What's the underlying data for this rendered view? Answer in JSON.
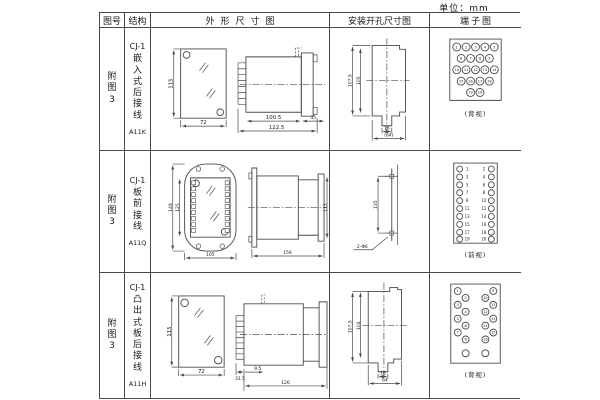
{
  "unit_label": "单位：mm",
  "headers": {
    "fig_no": "图号",
    "structure": "结构",
    "outline": "外形尺寸图",
    "install": "安装开孔尺寸图",
    "terminal": "端子图"
  },
  "rows": [
    {
      "fig": "附图3",
      "model": "CJ-1",
      "structure_type": "嵌入式后接线",
      "code": "A11K",
      "outline": {
        "height": "115",
        "width": "72",
        "body_len": "100.5",
        "total_len": "122.5",
        "flange_len": "35"
      },
      "install": {
        "outer_h": "107.5",
        "inner_h": "105",
        "slot_w": "16",
        "overall_w": "(64)"
      },
      "terminal": {
        "view": "(背视)",
        "numbers": [
          "1",
          "2",
          "3",
          "4",
          "5",
          "6",
          "7",
          "8",
          "9",
          "10",
          "11",
          "12",
          "13",
          "14",
          "15",
          "16",
          "17",
          "18",
          "19",
          "20"
        ]
      }
    },
    {
      "fig": "附图3",
      "model": "CJ-1",
      "structure_type": "板前接线",
      "code": "A11Q",
      "outline": {
        "outer_h": "149",
        "inner_h": "125",
        "width": "105",
        "length": "156",
        "height": "115"
      },
      "install": {
        "hole_spacing": "135",
        "hole_note": "2-Φ6"
      },
      "terminal": {
        "view": "(前视)",
        "left_numbers": [
          "1",
          "3",
          "5",
          "7",
          "9",
          "11",
          "13",
          "15",
          "17",
          "19"
        ],
        "right_numbers": [
          "2",
          "4",
          "6",
          "8",
          "10",
          "12",
          "14",
          "16",
          "18",
          "20"
        ]
      }
    },
    {
      "fig": "附图3",
      "model": "CJ-1",
      "structure_type": "凸出式板后接线",
      "code": "A11H",
      "outline": {
        "height": "115",
        "width": "72",
        "pin_len": "31.5",
        "offset": "9.5",
        "total_len": "126"
      },
      "install": {
        "outer_h": "107.5",
        "inner_h": "104",
        "slot_w": "16",
        "overall_w": "64"
      },
      "terminal": {
        "view": "(背视)",
        "numbers": [
          "1",
          "2",
          "3",
          "4",
          "5",
          "6",
          "7",
          "8",
          "9",
          "10",
          "11",
          "12",
          "13",
          "14",
          "15",
          "16"
        ]
      }
    }
  ]
}
